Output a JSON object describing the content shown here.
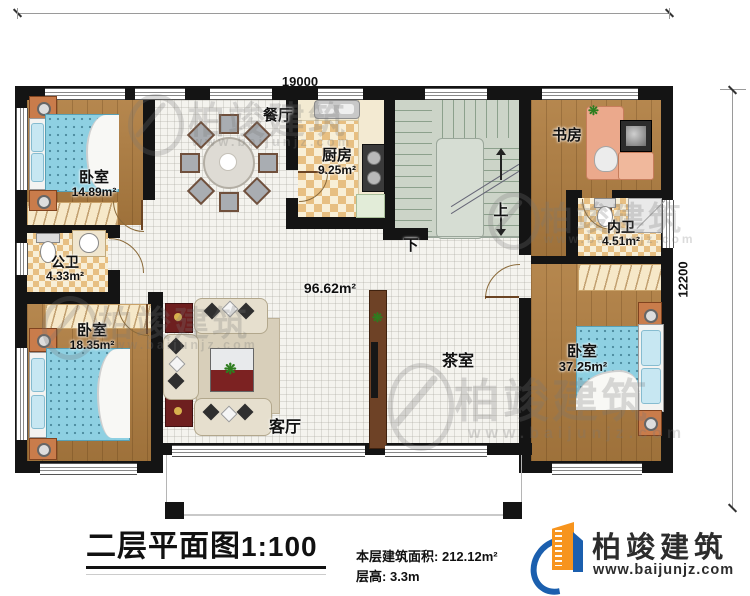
{
  "title": {
    "main": "二层平面图",
    "scale": "1:100"
  },
  "dimensions": {
    "width": "19000",
    "height": "12200"
  },
  "rooms": {
    "bedroom_top_left": {
      "name": "卧室",
      "area": "14.89m²"
    },
    "public_bath": {
      "name": "公卫",
      "area": "4.33m²"
    },
    "bedroom_bottom_left": {
      "name": "卧室",
      "area": "18.35m²"
    },
    "dining": {
      "name": "餐厅"
    },
    "kitchen": {
      "name": "厨房",
      "area": "9.25m²"
    },
    "living": {
      "name": "客厅",
      "area": "96.62m²"
    },
    "tea": {
      "name": "茶室"
    },
    "study": {
      "name": "书房"
    },
    "ensuite_bath": {
      "name": "内卫",
      "area": "4.51m²"
    },
    "bedroom_right": {
      "name": "卧室",
      "area": "37.25m²"
    }
  },
  "stairs": {
    "up": "上",
    "down": "下"
  },
  "info": {
    "floor_area_label": "本层建筑面积:",
    "floor_area_value": "212.12m²",
    "floor_height_label": "层高:",
    "floor_height_value": "3.3m"
  },
  "brand": {
    "name": "柏竣建筑",
    "website": "www.baijunjz.com"
  },
  "watermark": {
    "name": "柏竣建筑",
    "website": "www.baijunjz.com"
  },
  "colors": {
    "wall": "#141414",
    "brand_blue": "#1b5fae",
    "brand_orange": "#f7941d"
  }
}
